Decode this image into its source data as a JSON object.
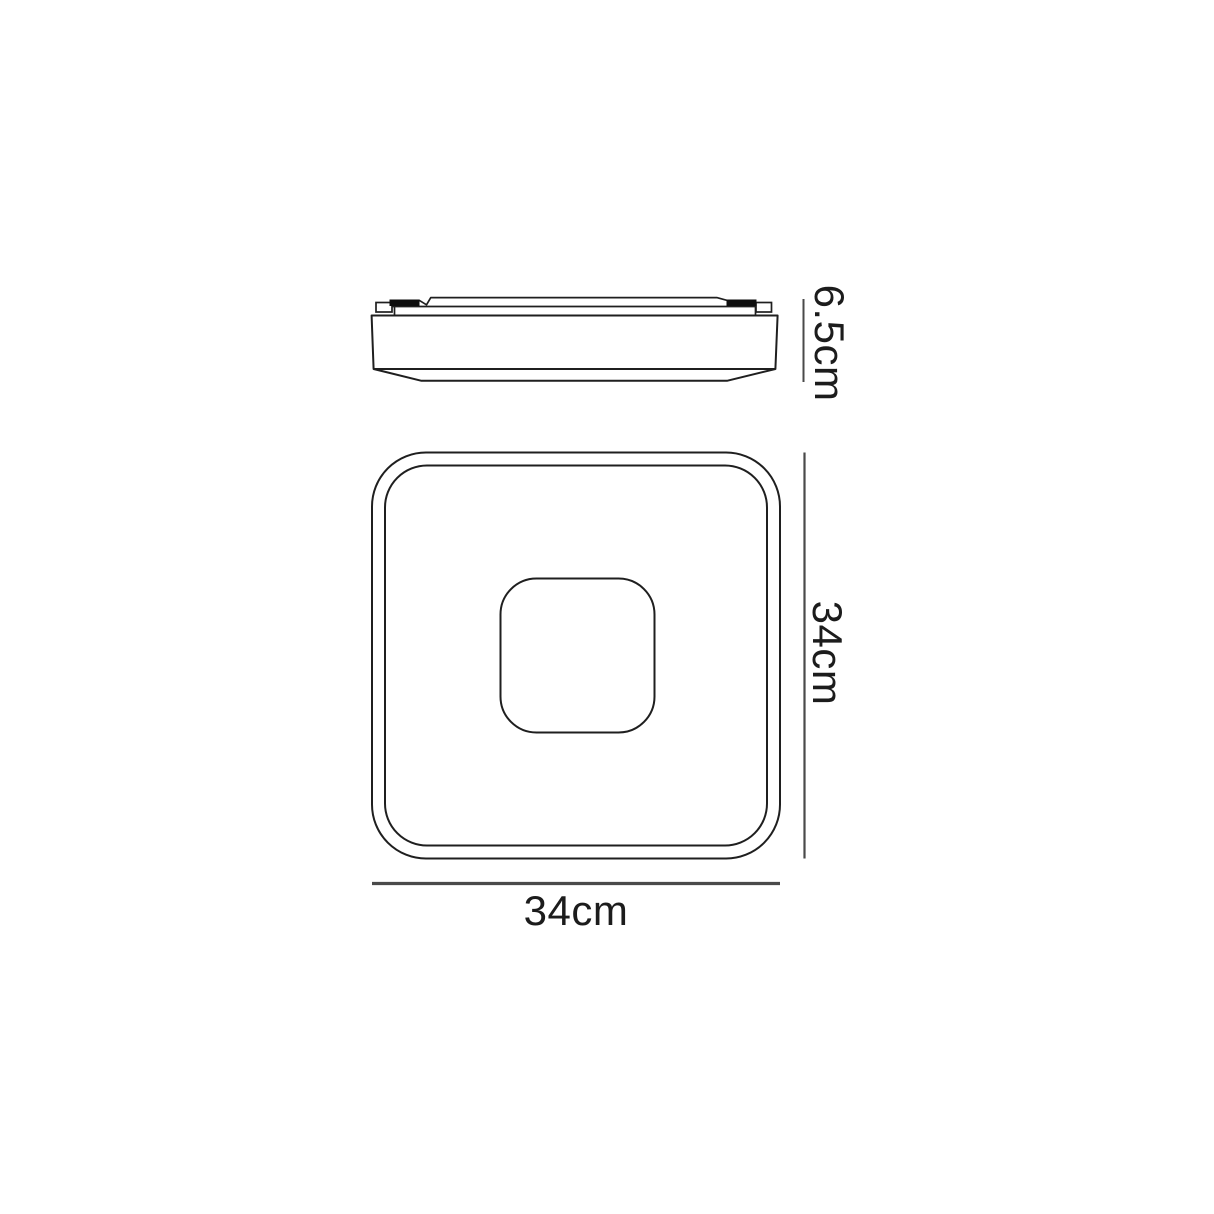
{
  "labels": {
    "side_height": "6.5cm",
    "plan_height": "34cm",
    "plan_width": "34cm"
  },
  "colors": {
    "bg": "#ffffff",
    "outline": "#1f1f1f",
    "clip": "#0e0e0e",
    "dim": "#4a4a4a",
    "text": "#1c1c1c"
  }
}
